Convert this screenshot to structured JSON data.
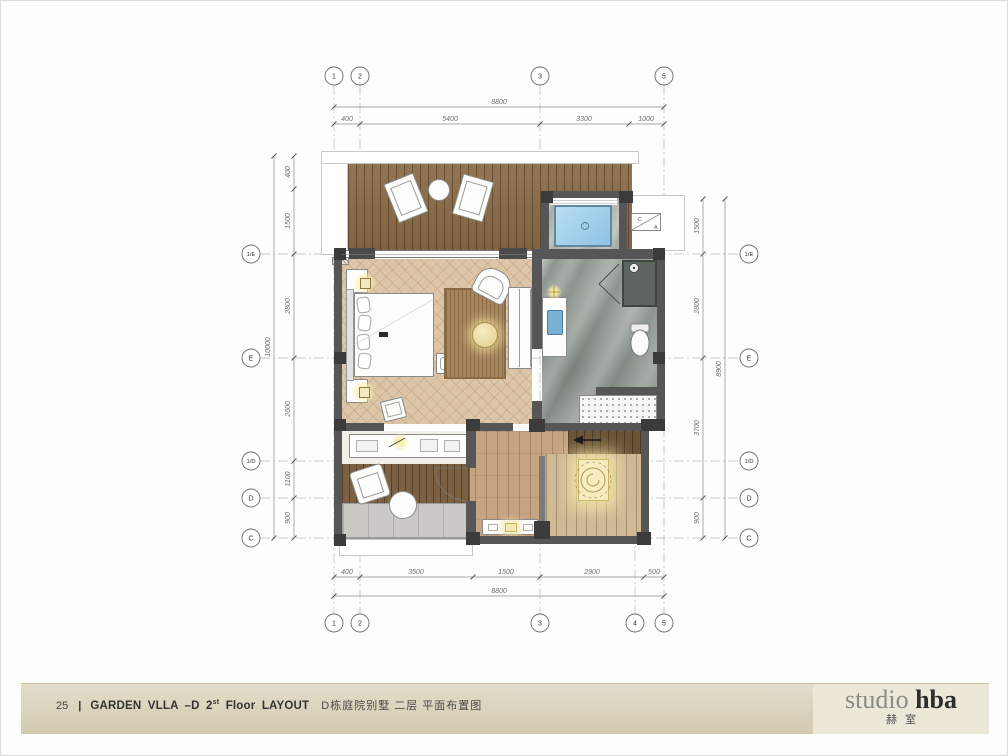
{
  "footer": {
    "page_number": "25",
    "divider": "|",
    "title_prefix": "GARDEN VLLA –D 2",
    "title_sup": "st",
    "title_suffix": "Floor LAYOUT",
    "title_cn": "D栋庭院别墅 二层 平面布置图"
  },
  "logo": {
    "studio": "studio",
    "hba": "hba",
    "cn": "赫室"
  },
  "grid": {
    "top": [
      "1",
      "2",
      "3",
      "5"
    ],
    "bottom": [
      "1",
      "2",
      "3",
      "4",
      "5"
    ],
    "left": [
      "1/E",
      "E",
      "1/D",
      "D",
      "C"
    ],
    "right": [
      "1/E",
      "E",
      "1/D",
      "D",
      "C"
    ]
  },
  "dimensions": {
    "top": {
      "overall": "8800",
      "segments": [
        "400",
        "5400",
        "3300",
        "1000"
      ]
    },
    "bottom": {
      "overall": "8800",
      "segments": [
        "400",
        "3500",
        "1500",
        "2900",
        "500"
      ]
    },
    "left": {
      "overall": "10000",
      "segments": [
        "400",
        "1500",
        "2800",
        "2600",
        "1100",
        "900"
      ]
    },
    "right": {
      "overall": "8900",
      "segments": [
        "1500",
        "2800",
        "3700",
        "900"
      ]
    }
  },
  "equipment": {
    "ac_label_left": "C",
    "ac_label_right": "A"
  },
  "colors": {
    "wall": "#565656",
    "deck_wood": "#8a6b45",
    "bedroom_floor": "#dcc6a7",
    "bathroom_marble": "#8e958e",
    "pool_water": "#a9d3ee",
    "hall_wood": "#c6a482",
    "balcony_wood": "#7b6142",
    "light_glow": "#f6e8ad",
    "footer_band": "#ddd7c1",
    "logo_gray": "#8b8b89",
    "logo_dark": "#2e2e2e"
  }
}
